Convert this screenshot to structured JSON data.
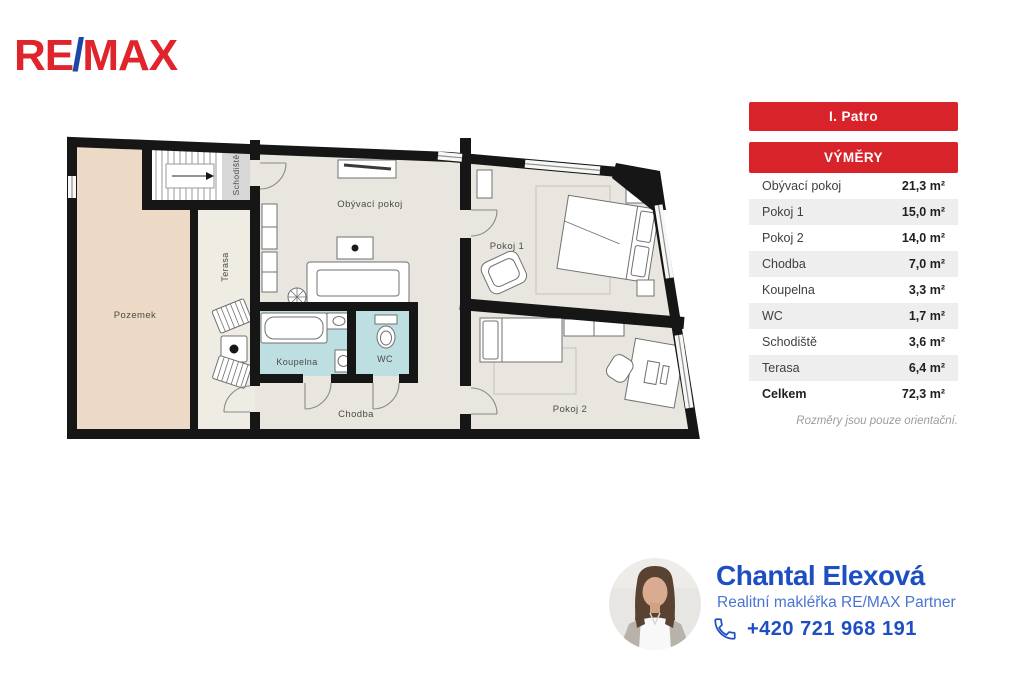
{
  "logo": {
    "part1": "RE",
    "slash": "/",
    "part2": "MAX"
  },
  "colors": {
    "remax_red": "#d8232a",
    "remax_blue": "#1b47a8",
    "accent_blue": "#1e4fc2",
    "wall": "#161616",
    "floor_fill": "#e9e6e0",
    "pozemek_fill": "#eddac6",
    "terasa_fill": "#eeece3",
    "bath_fill": "#bedfe2"
  },
  "floorplan": {
    "labels": {
      "pozemek": "Pozemek",
      "schodiste": "Schodiště",
      "terasa": "Terasa",
      "obyvaci_pokoj": "Obývací pokoj",
      "pokoj1": "Pokoj 1",
      "pokoj2": "Pokoj 2",
      "koupelna": "Koupelna",
      "wc": "WC",
      "chodba": "Chodba"
    }
  },
  "panel": {
    "floor_title": "I. Patro",
    "table_title": "VÝMĚRY",
    "rows": [
      {
        "label": "Obývací pokoj",
        "value": "21,3 m²"
      },
      {
        "label": "Pokoj 1",
        "value": "15,0 m²"
      },
      {
        "label": "Pokoj 2",
        "value": "14,0 m²"
      },
      {
        "label": "Chodba",
        "value": "7,0 m²"
      },
      {
        "label": "Koupelna",
        "value": "3,3 m²"
      },
      {
        "label": "WC",
        "value": "1,7 m²"
      },
      {
        "label": "Schodiště",
        "value": "3,6 m²"
      },
      {
        "label": "Terasa",
        "value": "6,4 m²"
      },
      {
        "label": "Celkem",
        "value": "72,3 m²"
      }
    ],
    "note": "Rozměry jsou pouze orientační."
  },
  "agent": {
    "name": "Chantal Elexová",
    "role": "Realitní makléřka RE/MAX Partner",
    "phone": "+420 721 968 191"
  }
}
